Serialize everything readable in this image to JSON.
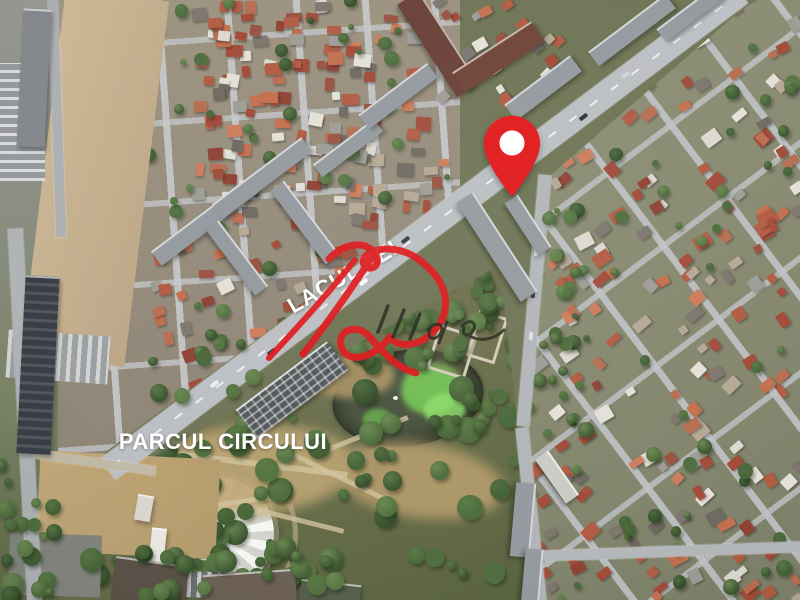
{
  "map": {
    "type": "satellite-imagery",
    "labels": [
      {
        "id": "road-label",
        "text": "LACUL TEI"
      },
      {
        "id": "park-label",
        "text": "PARCUL CIRCULUI"
      }
    ],
    "marker": {
      "shape": "pin",
      "color": "#e2191c",
      "inner_color": "#ffffff"
    },
    "watermark": {
      "kind": "handwritten-signature",
      "primary_color": "#df191d",
      "ink_color": "#262c1e"
    }
  }
}
